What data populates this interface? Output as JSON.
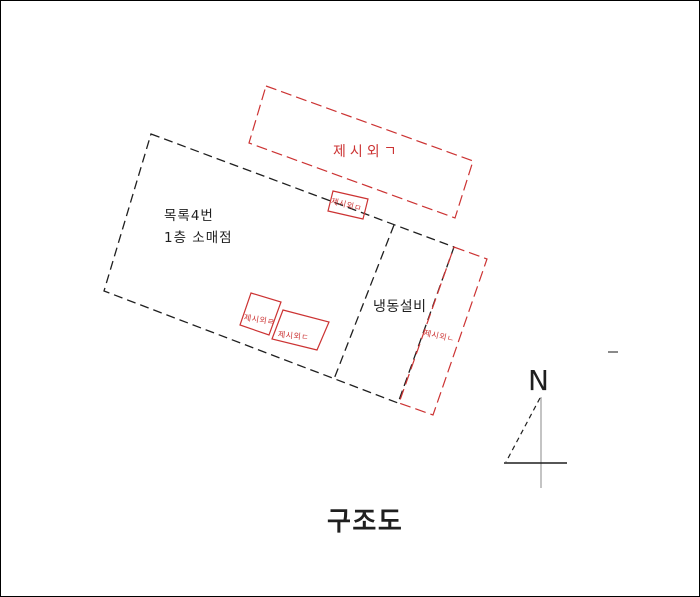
{
  "page": {
    "title": "구조도",
    "north_label": "N"
  },
  "colors": {
    "annex_red": "#cc3333",
    "line_black": "#1f1f1f",
    "line_gray": "#8a8a8a"
  },
  "building": {
    "label_line1": "목록4번",
    "label_line2": "1층 소매점",
    "room_label": "냉동설비"
  },
  "annexes": {
    "top": "제시외ㄱ",
    "right_strip": "제시외ㄴ",
    "small_d": "제시외ㄷ",
    "small_r": "제시외ㄹ",
    "small_m": "제시외ㅁ"
  }
}
